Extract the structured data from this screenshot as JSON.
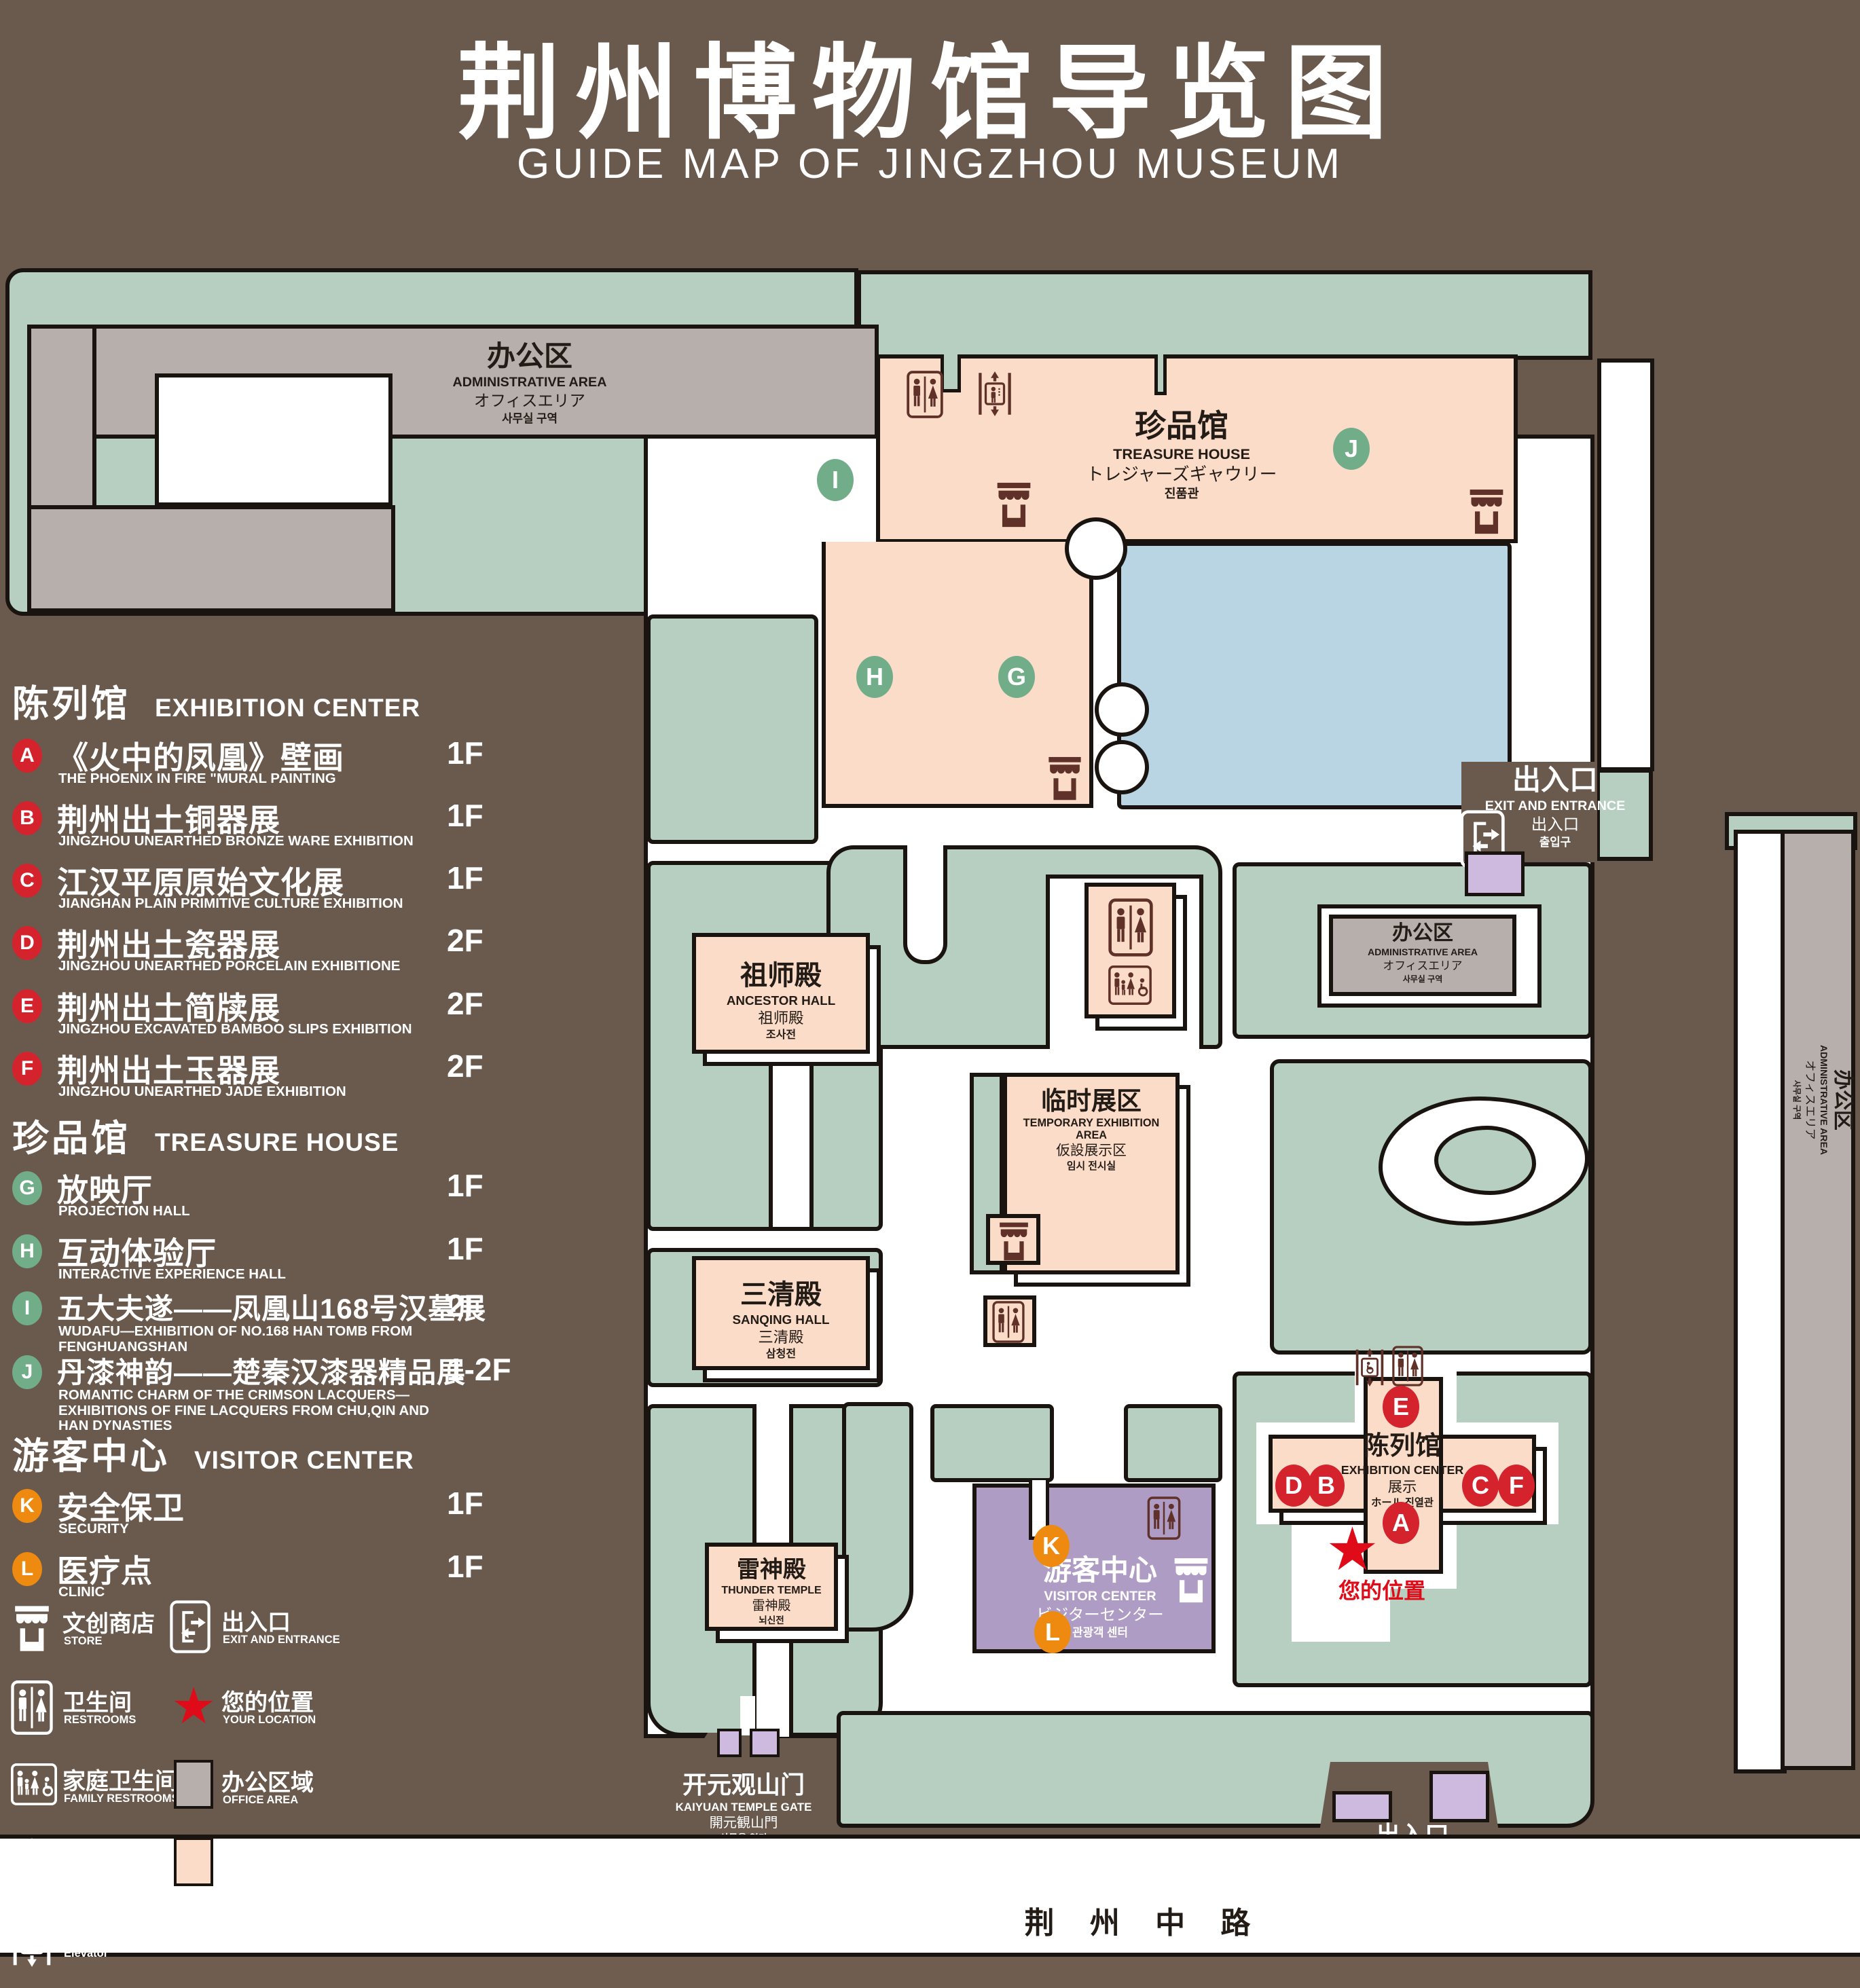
{
  "title": {
    "zh": "荆州博物馆导览图",
    "en": "GUIDE MAP OF JINGZHOU MUSEUM"
  },
  "legend": {
    "sections": [
      {
        "zh": "陈列馆",
        "en": "EXHIBITION CENTER",
        "items": [
          {
            "letter": "A",
            "zh": "《火中的凤凰》壁画",
            "en": "THE PHOENIX IN FIRE \"MURAL PAINTING",
            "floor": "1F"
          },
          {
            "letter": "B",
            "zh": "荆州出土铜器展",
            "en": "JINGZHOU UNEARTHED BRONZE WARE EXHIBITION",
            "floor": "1F"
          },
          {
            "letter": "C",
            "zh": "江汉平原原始文化展",
            "en": "JIANGHAN PLAIN PRIMITIVE CULTURE EXHIBITION",
            "floor": "1F"
          },
          {
            "letter": "D",
            "zh": "荆州出土瓷器展",
            "en": "JINGZHOU UNEARTHED PORCELAIN EXHIBITIONE",
            "floor": "2F"
          },
          {
            "letter": "E",
            "zh": "荆州出土简牍展",
            "en": "JINGZHOU EXCAVATED BAMBOO SLIPS EXHIBITION",
            "floor": "2F"
          },
          {
            "letter": "F",
            "zh": "荆州出土玉器展",
            "en": "JINGZHOU UNEARTHED JADE EXHIBITION",
            "floor": "2F"
          }
        ]
      },
      {
        "zh": "珍品馆",
        "en": "TREASURE HOUSE",
        "items": [
          {
            "letter": "G",
            "zh": "放映厅",
            "en": "PROJECTION HALL",
            "floor": "1F"
          },
          {
            "letter": "H",
            "zh": "互动体验厅",
            "en": "INTERACTIVE EXPERIENCE HALL",
            "floor": "1F"
          },
          {
            "letter": "I",
            "zh": "五大夫遂——凤凰山168号汉墓展",
            "en": "WUDAFU—EXHIBITION OF NO.168 HAN TOMB FROM FENGHUANGSHAN",
            "floor": "2F"
          },
          {
            "letter": "J",
            "zh": "丹漆神韵——楚秦汉漆器精品展",
            "en": "ROMANTIC CHARM OF THE CRIMSON LACQUERS—EXHIBITIONS OF FINE LACQUERS FROM CHU,QIN AND HAN DYNASTIES",
            "floor": "1-2F"
          }
        ]
      },
      {
        "zh": "游客中心",
        "en": "VISITOR CENTER",
        "items": [
          {
            "letter": "K",
            "zh": "安全保卫",
            "en": "SECURITY",
            "floor": "1F"
          },
          {
            "letter": "L",
            "zh": "医疗点",
            "en": "CLINIC",
            "floor": "1F"
          }
        ]
      }
    ],
    "icons": [
      {
        "icon": "store-icon",
        "zh": "文创商店",
        "en": "STORE"
      },
      {
        "icon": "exit-icon",
        "zh": "出入口",
        "en": "EXIT AND ENTRANCE"
      },
      {
        "icon": "restrooms-icon",
        "zh": "卫生间",
        "en": "RESTROOMS"
      },
      {
        "icon": "location-star-icon",
        "zh": "您的位置",
        "en": "YOUR LOCATION"
      },
      {
        "icon": "family-restrooms-icon",
        "zh": "家庭卫生间",
        "en": "FAMILY RESTROOMS"
      },
      {
        "icon": "office-area-swatch",
        "zh": "办公区域",
        "en": "OFFICE AREA"
      },
      {
        "icon": "accessible-elevator-icon",
        "zh": "无障碍电梯",
        "en": "ACCESSIBLE ELEVATOR"
      },
      {
        "icon": "display-area-swatch",
        "zh": "展示区域",
        "en": "DISPLAY AREA"
      },
      {
        "icon": "elevator-icon",
        "zh": "电梯",
        "en": "Elevator"
      }
    ]
  },
  "map": {
    "buildings": {
      "admin_nw": {
        "zh": "办公区",
        "en": "ADMINISTRATIVE AREA",
        "l3": "オフィスエリア",
        "l4": "사무실 구역"
      },
      "treasure": {
        "zh": "珍品馆",
        "en": "TREASURE HOUSE",
        "l3": "トレジャーズギャウリー",
        "l4": "진품관"
      },
      "ancestor": {
        "zh": "祖师殿",
        "en": "ANCESTOR HALL",
        "l3": "祖师殿",
        "l4": "조사전"
      },
      "temporary": {
        "zh": "临时展区",
        "en": "TEMPORARY EXHIBITION AREA",
        "l3": "仮設展示区",
        "l4": "임시 전시실"
      },
      "admin_e": {
        "zh": "办公区",
        "en": "ADMINISTRATIVE AREA",
        "l3": "オフィスエリア",
        "l4": "사무실 구역"
      },
      "admin_strip": {
        "zh": "办公区",
        "en": "ADMINISTRATIVE AREA",
        "l3": "オフィスエリア",
        "l4": "사무실 구역"
      },
      "sanqing": {
        "zh": "三清殿",
        "en": "SANQING HALL",
        "l3": "三清殿",
        "l4": "삼청전"
      },
      "thunder": {
        "zh": "雷神殿",
        "en": "THUNDER TEMPLE",
        "l3": "雷神殿",
        "l4": "뇌신전"
      },
      "visitor": {
        "zh": "游客中心",
        "en": "VISITOR CENTER",
        "l3": "ビジターセンター",
        "l4": "관광객 센터"
      },
      "exhibition": {
        "zh": "陈列馆",
        "en": "EXHIBITION CENTER",
        "l3": "展示",
        "l4": "ホール 진열관"
      },
      "gate_w": {
        "zh": "开元观山门",
        "en": "KAIYUAN TEMPLE GATE",
        "l3": "開元観山門",
        "l4": "산문을 열다"
      },
      "exit_e": {
        "zh": "出入口",
        "en": "EXIT AND ENTRANCE",
        "l3": "出入口",
        "l4": "출입구"
      },
      "exit_s": {
        "zh": "出入口",
        "en": "EXIT AND ENTRANCE",
        "l3": "出入口",
        "l4": "출입구"
      }
    },
    "road": {
      "name": "荆 州 中 路"
    },
    "your_location": "您的位置",
    "marker_letters": {
      "A": "A",
      "B": "B",
      "C": "C",
      "D": "D",
      "E": "E",
      "F": "F",
      "G": "G",
      "H": "H",
      "I": "I",
      "J": "J",
      "K": "K",
      "L": "L"
    }
  },
  "colors": {
    "background": "#6a594d",
    "landscape_green": "#b6cfc1",
    "display_area_pink": "#fadcc9",
    "office_area_gray": "#b6afac",
    "pond_blue": "#b9d4e2",
    "visitor_purple": "#ae9cc4",
    "gate_purple": "#cdbade",
    "marker_red": "#d5232e",
    "marker_green": "#72ad8a",
    "marker_orange": "#ef8a10",
    "icon_maroon": "#5f3128",
    "location_star_red": "#e00b18"
  }
}
